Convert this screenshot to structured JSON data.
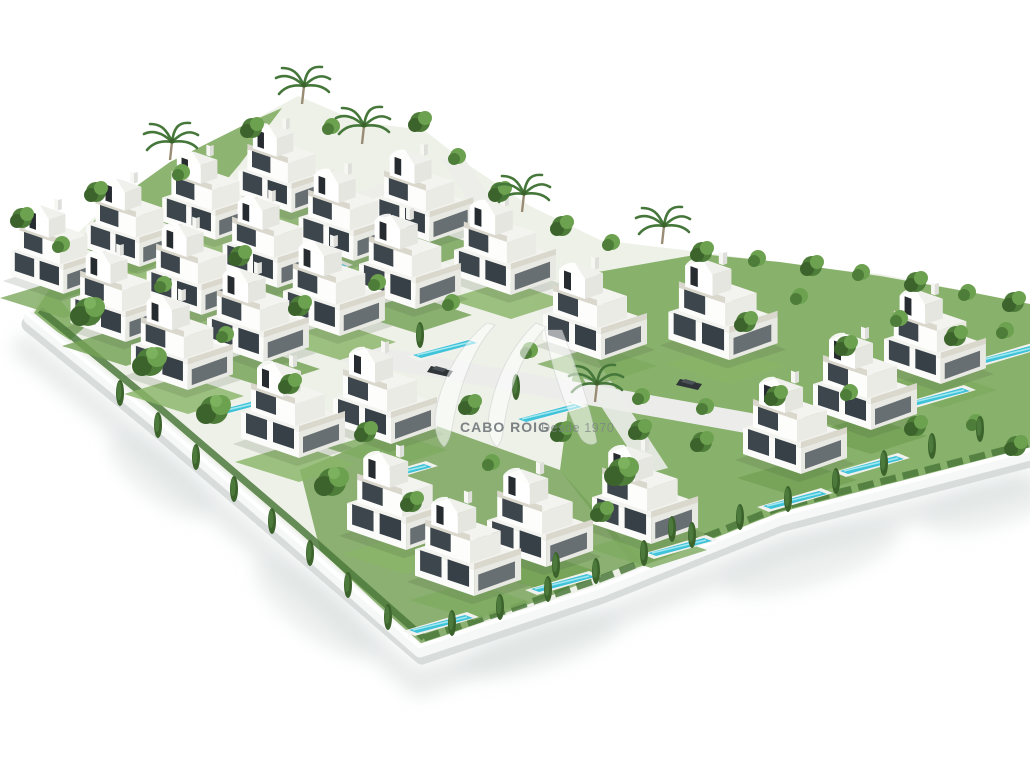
{
  "image": {
    "type": "3d-architectural-render",
    "subject": "Aerial isometric rendering of a gated residential development of modern white villas with rooftop terraces, private pools, mediterranean gardens and a white perimeter wall on a white background",
    "background": "#ffffff"
  },
  "watermark": {
    "brand": "CABO ROIG",
    "tagline": "Desde 1970",
    "logo": "av-monogram"
  },
  "palette": {
    "background": "#ffffff",
    "villa_white": "#fbfbf9",
    "villa_shade": "#e9e9e4",
    "villa_roof": "#f3f3ef",
    "glass_dark": "#3d464c",
    "penthouse_glass": "#272c30",
    "terrace_rail": "#dad7cd",
    "grass_green": "#7fab60",
    "tree_green": "#4e7d39",
    "tree_dark": "#3c632c",
    "tree_light": "#6ca14f",
    "pool_blue": "#3fc3d8",
    "pool_highlight": "#a3e8f0",
    "pool_deck": "#f1f1ee",
    "wall_white": "#f6f7f7",
    "wall_edge": "#d8dddc",
    "ground_shadow": "#dadfde",
    "road_gray": "#ecedea",
    "watermark_white_opacity": "0.55",
    "watermark_text_gray": "#5f656a"
  },
  "scene": {
    "villa_count": 25,
    "pool_count": 12,
    "car_count": 2,
    "features": "stepped three-storey villas with curved penthouse parapets, palm trees, cypress hedges along the boundary wall, internal white roads"
  }
}
